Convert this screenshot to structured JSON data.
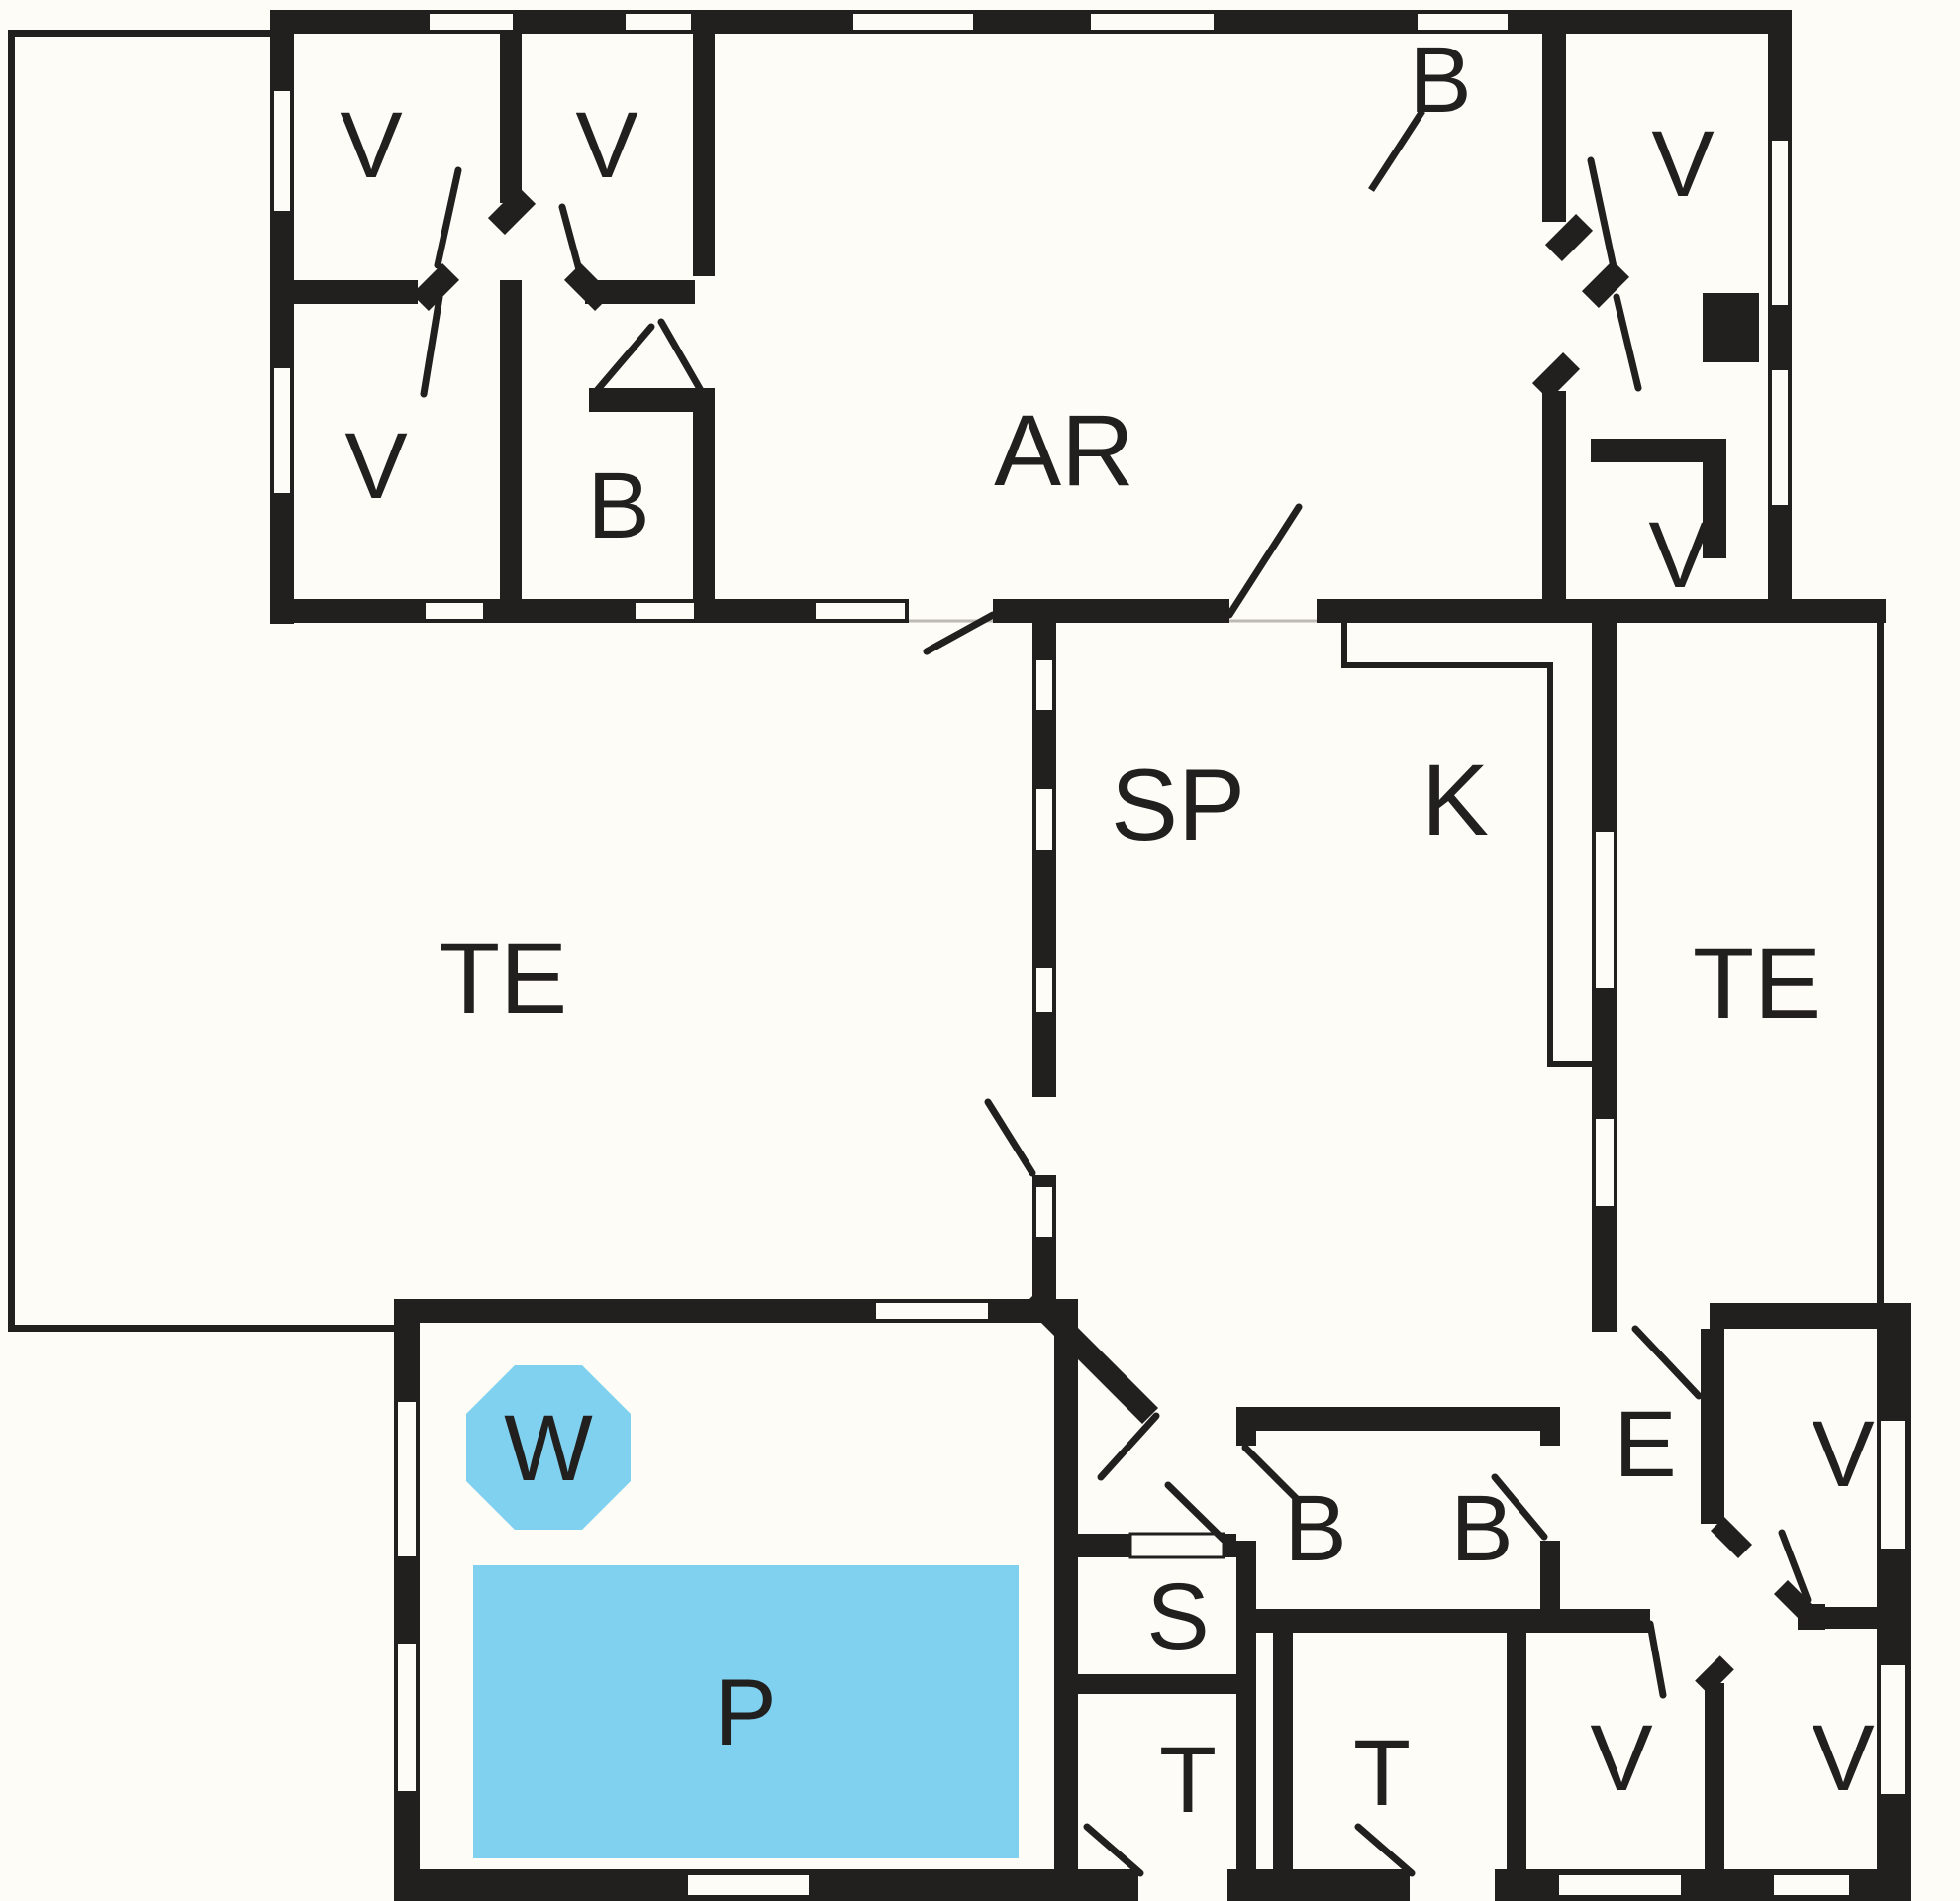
{
  "plan": {
    "type": "residential-floor-plan",
    "wall_color": "#221f1f",
    "water_color": "#7fd1ef",
    "background_color": "#fdfcf7",
    "room_label_count": 23
  },
  "rooms": [
    {
      "id": "bedroom-top-left-1",
      "label": "V"
    },
    {
      "id": "bedroom-top-left-2",
      "label": "V"
    },
    {
      "id": "bedroom-top-left-3",
      "label": "V"
    },
    {
      "id": "bath-top-left",
      "label": "B"
    },
    {
      "id": "living-room",
      "label": "AR"
    },
    {
      "id": "bath-top-right",
      "label": "B"
    },
    {
      "id": "bedroom-top-right-1",
      "label": "V"
    },
    {
      "id": "bedroom-top-right-2",
      "label": "V"
    },
    {
      "id": "dining-room",
      "label": "SP"
    },
    {
      "id": "kitchen",
      "label": "K"
    },
    {
      "id": "terrace-left",
      "label": "TE"
    },
    {
      "id": "terrace-right",
      "label": "TE"
    },
    {
      "id": "whirlpool",
      "label": "W"
    },
    {
      "id": "pool",
      "label": "P"
    },
    {
      "id": "sauna",
      "label": "S"
    },
    {
      "id": "toilet-small",
      "label": "T"
    },
    {
      "id": "bath-middle-1",
      "label": "B"
    },
    {
      "id": "bath-middle-2",
      "label": "B"
    },
    {
      "id": "toilet-big",
      "label": "T"
    },
    {
      "id": "entrance",
      "label": "E"
    },
    {
      "id": "bedroom-bottom-mid",
      "label": "V"
    },
    {
      "id": "bedroom-bottom-right",
      "label": "V"
    },
    {
      "id": "bedroom-right-top",
      "label": "V"
    }
  ]
}
